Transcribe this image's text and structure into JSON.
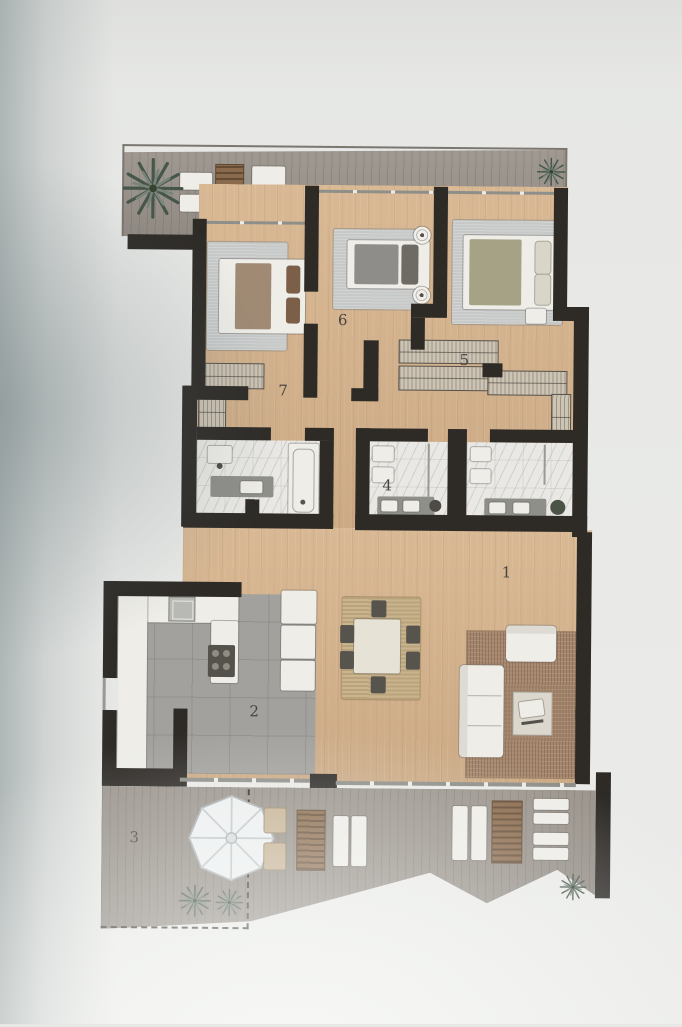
{
  "rooms": [
    {
      "id": "living-room",
      "label": "1"
    },
    {
      "id": "kitchen",
      "label": "2"
    },
    {
      "id": "terrace",
      "label": "3"
    },
    {
      "id": "bathroom",
      "label": "4"
    },
    {
      "id": "bedroom-right",
      "label": "5"
    },
    {
      "id": "bedroom-middle",
      "label": "6"
    },
    {
      "id": "dressing-room",
      "label": "7"
    }
  ],
  "colors": {
    "wall": "#2e2b27",
    "wood_floor": "#d6b38c",
    "kitchen_tile": "#a2a19d",
    "terrace_deck": "#9a938b",
    "bathroom_marble": "#e9e8e4",
    "rug_gray": "#c7c9c9",
    "rug_living": "#a5866c",
    "rug_jute": "#c9b48e",
    "furniture_white": "#eeede8",
    "wood_accent": "#8a6a4c",
    "plant_green": "#47564b"
  }
}
